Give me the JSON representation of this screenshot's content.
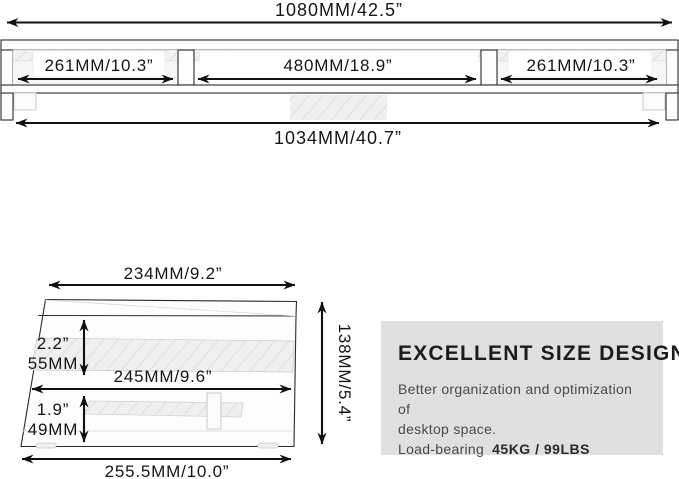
{
  "front_view": {
    "total_width": "1080MM/42.5”",
    "left_section": "261MM/10.3”",
    "middle_section": "480MM/18.9”",
    "right_section": "261MM/10.3”",
    "base_width": "1034MM/40.7”"
  },
  "side_view": {
    "top_depth": "234MM/9.2”",
    "upper_clearance_in": "2.2”",
    "upper_clearance_mm": "55MM",
    "middle_depth": "245MM/9.6”",
    "lower_clearance_in": "1.9”",
    "lower_clearance_mm": "49MM",
    "total_height": "138MM/5.4”",
    "base_depth": "255.5MM/10.0”"
  },
  "info_panel": {
    "title": "EXCELLENT SIZE DESIGN",
    "line1": "Better organization and optimization of",
    "line2": "desktop space.",
    "load_label": "Load-bearing",
    "load_value": "45KG / 99LBS"
  },
  "colors": {
    "line": "#111111",
    "panel_bg": "#e0e0e0",
    "panel_title": "#1c1c1c",
    "panel_text": "#4a4a4a",
    "drawing_fill": "#fdfdfd"
  }
}
